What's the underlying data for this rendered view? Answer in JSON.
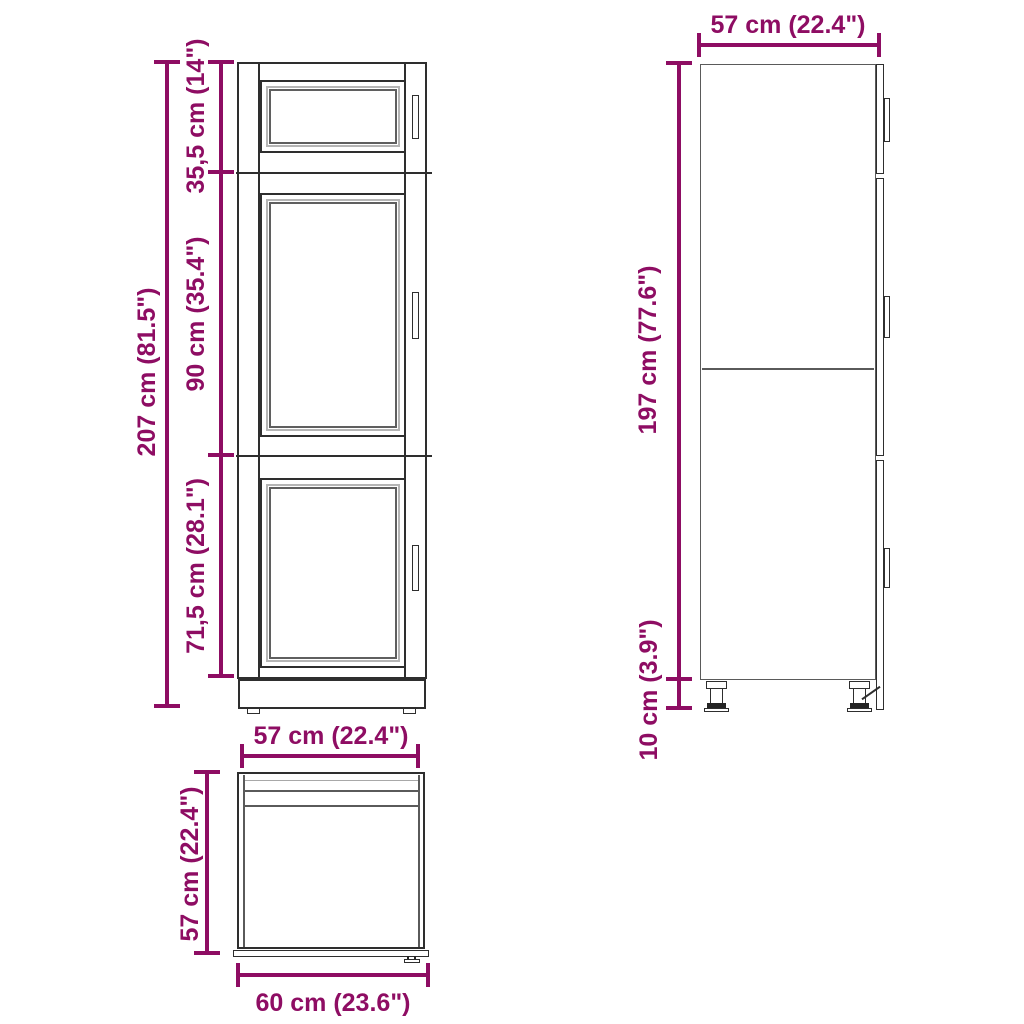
{
  "diagram": {
    "colors": {
      "dimension": "#8e0d63",
      "outline": "#2e2e2e"
    },
    "front_view": {
      "overall_height": "207 cm (81.5\")",
      "section_top": "35,5 cm (14\")",
      "section_middle": "90 cm (35.4\")",
      "section_bottom": "71,5 cm (28.1\")"
    },
    "side_view": {
      "depth": "57 cm (22.4\")",
      "body_height": "197 cm (77.6\")",
      "leg_height": "10 cm (3.9\")"
    },
    "top_view": {
      "width": "57 cm (22.4\")",
      "depth": "57 cm (22.4\")",
      "overall_depth": "60 cm (23.6\")"
    }
  }
}
